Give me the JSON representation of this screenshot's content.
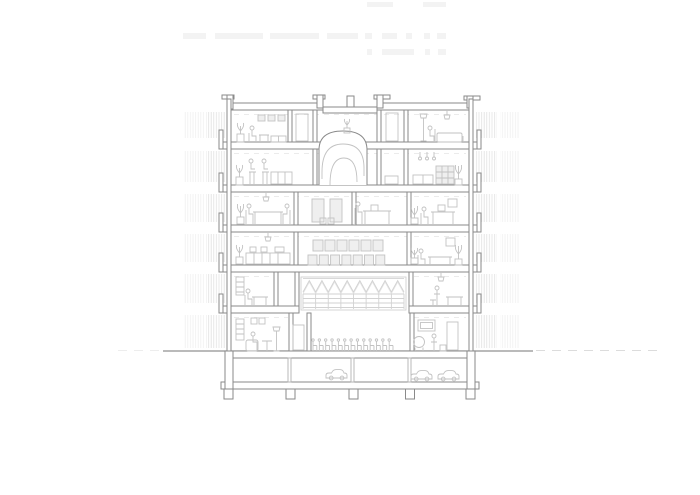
{
  "page": {
    "background": "#ffffff",
    "description": "Monochrome architectural cross-section drawing: six storeys over a basement car park, central double-height assembly hall with roof truss and chair row, sculptural spiral stair in the top two floors, balconies with railing hatch on both sides, furnished rooms with people and plants"
  },
  "colors": {
    "background": "#ffffff",
    "structure": "#8a8a8a",
    "structure_light": "#b3b3b3",
    "furniture": "#c2c2c2",
    "truss": "#d2d2d2",
    "hatch": "#dcdcdc",
    "ground": "#909090",
    "faint": "#f3f3f3"
  },
  "section": {
    "floors_above_ground": 6,
    "basement_levels": 1,
    "balcony_levels_per_side": 5,
    "hatch_bands_per_side": 6,
    "stair": {
      "type": "spiral",
      "floors_spanned": 2
    },
    "hall": {
      "truss_zigzag_peaks": 8,
      "truss_panel_columns": 8,
      "seat_row_counts": [
        6,
        7
      ],
      "ground_floor_chair_count": 13
    },
    "basement": {
      "car_count": 3,
      "column_count": 3,
      "footing_count": 5
    }
  }
}
